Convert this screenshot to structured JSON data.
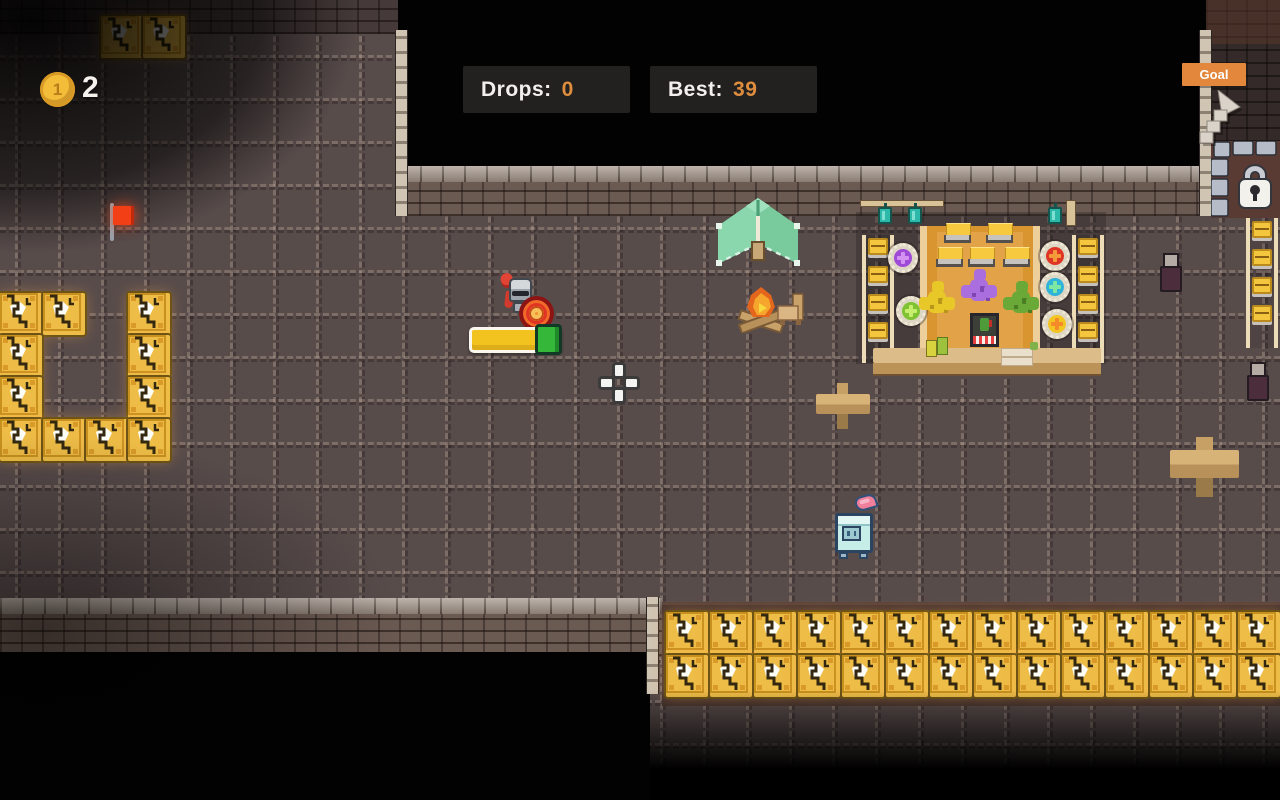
{
  "hud": {
    "coin_face": "1",
    "coin_count": "2",
    "drops_label": "Drops:",
    "drops_value": "0",
    "best_label": "Best:",
    "best_value": "39",
    "goal_label": "Goal"
  },
  "colors": {
    "floor": "#584c4b",
    "hud_panel_bg": "#232020",
    "hud_value_orange": "#de8d3e",
    "goal_badge_bg": "#e2873b",
    "crate_gold": "#eebd47",
    "tent_green": "#79cb9e",
    "carpet_orange": "#d9952f",
    "machine_teal": "#c6ede8",
    "health_yellow": "#f2c21f",
    "health_green": "#35b83a",
    "flag_red": "#f23f16"
  },
  "map": {
    "tile_size": 43,
    "grid_offset_x": 15,
    "grid_offset_y": 12,
    "left_crates": [
      [
        0,
        293
      ],
      [
        43,
        293
      ],
      [
        128,
        293
      ],
      [
        0,
        335
      ],
      [
        128,
        335
      ],
      [
        0,
        377
      ],
      [
        128,
        377
      ],
      [
        0,
        419
      ],
      [
        43,
        419
      ],
      [
        86,
        419
      ],
      [
        128,
        419
      ]
    ],
    "top_crates": [
      [
        101,
        16
      ],
      [
        143,
        16
      ]
    ],
    "bottom_crate_rows": {
      "x": 666,
      "y": 612,
      "cols": 14,
      "rows": 2,
      "step_x": 44,
      "step_y": 43
    }
  }
}
